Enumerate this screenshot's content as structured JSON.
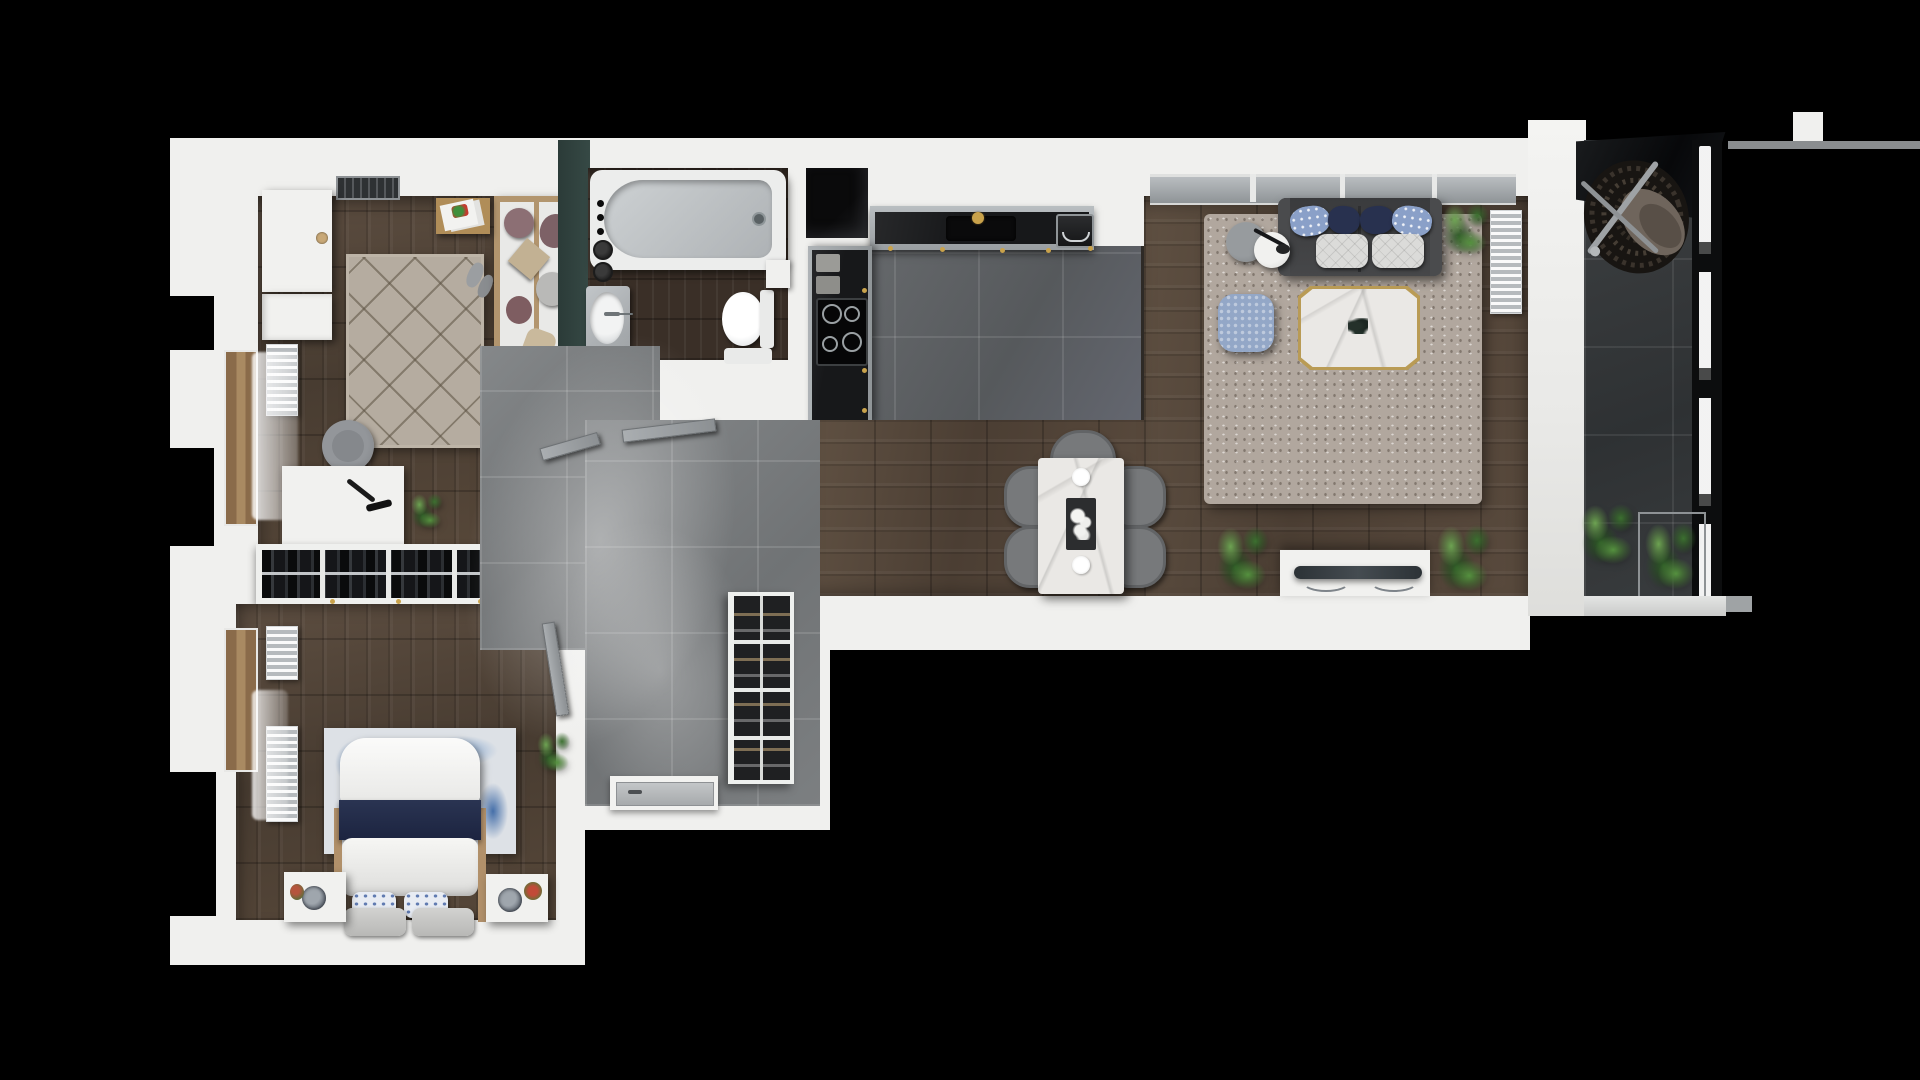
{
  "scene": {
    "title": "Apartment 3D Floor Plan",
    "style": "top-down architectural 3D render",
    "background_color": "#000000"
  },
  "palette": {
    "wall_white": "#f0f0ee",
    "wood_floor": "#57473a",
    "bathroom_wood_floor": "#3a2f27",
    "hall_tile": "#7d8083",
    "kitchen_tile": "#626568",
    "balcony_tile": "#36393b",
    "counter_black": "#17181a",
    "counter_trim_gray": "#a3a8ab",
    "teal_accent_wall": "#31433f",
    "brass_gold": "#c9a24b",
    "sofa_gray": "#414244",
    "navy_textile": "#28314f",
    "light_blue_textile": "#8aa0c8",
    "office_rug_beige": "#b5aca0",
    "living_rug_taupe": "#b1a79e",
    "bedroom_rug_blue": "#4070ac",
    "plant_green": "#55913f",
    "wood_frame_tan": "#b1906a"
  },
  "rooms": {
    "office": {
      "label": "Second bedroom / office",
      "floor": "dark wood planks",
      "furniture": [
        "white wardrobe with round knob",
        "lower white cabinet",
        "wall radiator",
        "beige diamond-pattern rug",
        "wooden daybed with mauve and beige cushions",
        "wooden side table with magazines",
        "white desk with black lamp",
        "gray upholstered chair",
        "potted plant",
        "slippers",
        "ceiling vent",
        "sheer curtain at balcony window"
      ]
    },
    "bathroom": {
      "label": "Bathroom",
      "floor": "dark wood-look planks",
      "furniture": [
        "bathtub with faucet",
        "shower mixer knobs on teal wall",
        "vanity sink with oval basin",
        "toilet with cistern",
        "tall white cabinet",
        "white bath mat"
      ]
    },
    "kitchen": {
      "label": "Kitchen",
      "floor": "dark gray tiles",
      "furniture": [
        "black worktop with gray trim and brass knobs",
        "undermount sink with brass faucet",
        "coffee machine",
        "induction hob with four burners",
        "cutting boards",
        "black service shaft"
      ]
    },
    "living_dining": {
      "label": "Living / dining room",
      "floor": "wood planks",
      "furniture": [
        "two-seat dark gray sofa with navy and patterned blue pillows and quilted cushions",
        "window band above sofa",
        "taupe shaggy rug",
        "white marble coffee table with gold trim and leaf decor",
        "knitted light-blue pouf",
        "gray round side table",
        "white round side table with black lamp",
        "white marble dining table with dark tray and white flowers and two plates",
        "five gray dining chairs",
        "white TV console with flat TV",
        "three potted plants",
        "wall radiator"
      ]
    },
    "hall": {
      "label": "Entrance hall",
      "floor": "large gray tiles with light haze",
      "furniture": [
        "open wardrobe row with hanging clothes and silver rail",
        "black shoe rack with four shelves",
        "front door threshold",
        "open interior doors to office, bedroom and bathroom"
      ]
    },
    "bedroom": {
      "label": "Main bedroom",
      "floor": "dark wood planks",
      "furniture": [
        "double bed with white duvet and navy runner",
        "two blue floral pillows and two gray pillows",
        "blue-and-white abstract rug",
        "two white nightstands with round lamps and small plants",
        "two wall radiators",
        "potted plant",
        "balcony window with wooden frame and sheer curtain"
      ]
    },
    "balcony": {
      "label": "Balcony",
      "floor": "dark anthracite tiles",
      "furniture": [
        "hanging rattan egg chair",
        "dark glass canopy",
        "glass railing with black frame",
        "two green plants",
        "wire planter box",
        "white outer sill"
      ]
    }
  }
}
